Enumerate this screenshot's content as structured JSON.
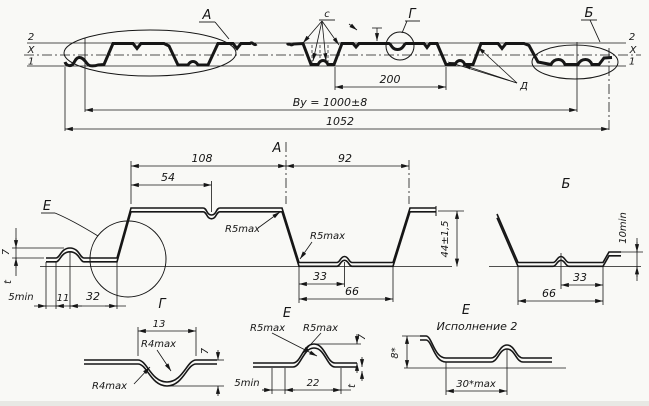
{
  "drawing_title": "Profiled sheet cross-section drawing",
  "top_view": {
    "ref_left": [
      "2",
      "X",
      "1"
    ],
    "ref_right": [
      "2",
      "X",
      "1"
    ],
    "label_a": "А",
    "label_c": "с",
    "label_g": "Г",
    "label_b": "Б",
    "label_d": "Д",
    "dim_pitch": "200",
    "dim_width": "Вy = 1000±8",
    "dim_total": "1052"
  },
  "view_a": {
    "title": "А",
    "dim_108": "108",
    "dim_54": "54",
    "dim_92": "92",
    "dim_height": "44±1,5",
    "radius_top": "R5max",
    "radius_bottom": "R5max",
    "dim_33": "33",
    "dim_66": "66",
    "dim_5min": "5min",
    "dim_11": "11",
    "dim_32": "32",
    "dim_7": "7",
    "dim_t": "t",
    "detail_label": "Е"
  },
  "view_b": {
    "title": "Б",
    "dim_10min": "10min",
    "dim_33": "33",
    "dim_66": "66"
  },
  "detail_g": {
    "title": "Г",
    "dim_13": "13",
    "radius_top": "R4max",
    "radius_bottom": "R4max",
    "dim_7": "7"
  },
  "detail_e": {
    "title": "Е",
    "radius_left": "R5max",
    "radius_right": "R5max",
    "dim_5min": "5min",
    "dim_22": "22",
    "dim_7": "7",
    "dim_t": "t"
  },
  "detail_e2": {
    "title": "Е",
    "subtitle": "Исполнение 2",
    "dim_height": "8*",
    "dim_width": "30*max"
  }
}
